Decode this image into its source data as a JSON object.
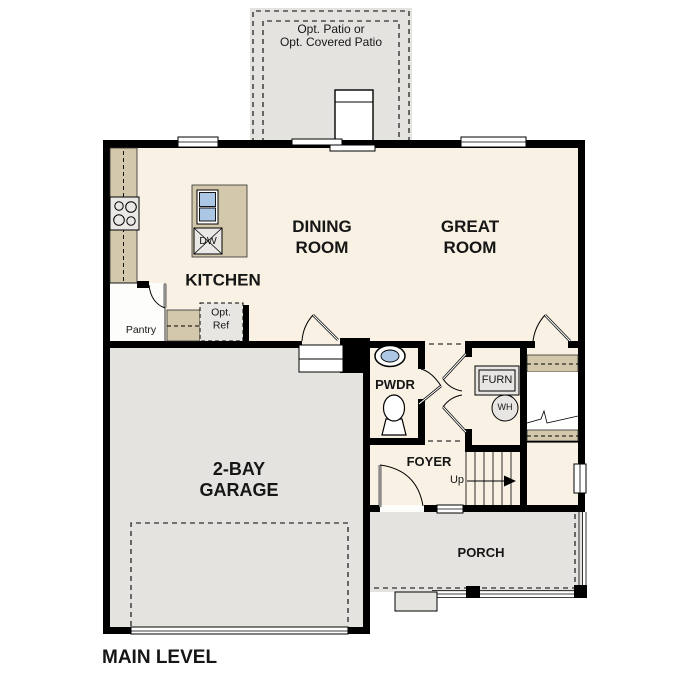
{
  "plan_title": "MAIN LEVEL",
  "labels": {
    "patio_line1": "Opt. Patio or",
    "patio_line2": "Opt. Covered Patio",
    "dining_line1": "DINING",
    "dining_line2": "ROOM",
    "great_line1": "GREAT",
    "great_line2": "ROOM",
    "kitchen": "KITCHEN",
    "pantry": "Pantry",
    "opt_ref_line1": "Opt.",
    "opt_ref_line2": "Ref",
    "dishwasher": "DW",
    "powder_room": "PWDR",
    "furnace": "FURN",
    "water_heater": "WH",
    "foyer": "FOYER",
    "stairs_direction": "Up",
    "garage_line1": "2-BAY",
    "garage_line2": "GARAGE",
    "porch": "PORCH"
  },
  "fixtures": [
    "stove-icon",
    "kitchen-sink-icon",
    "dishwasher-icon",
    "fireplace-icon",
    "vanity-sink-icon",
    "toilet-icon",
    "furnace-icon",
    "water-heater-icon",
    "stairs-up-icon",
    "garage-door-icon"
  ],
  "colors": {
    "wall": "#000000",
    "floor": "#f8f1e4",
    "counter": "#d3c7ac",
    "concrete": "#e4e3e0",
    "water_fixture": "#abc7e5",
    "appliance": "#e9e8e5",
    "text": "#161616"
  }
}
